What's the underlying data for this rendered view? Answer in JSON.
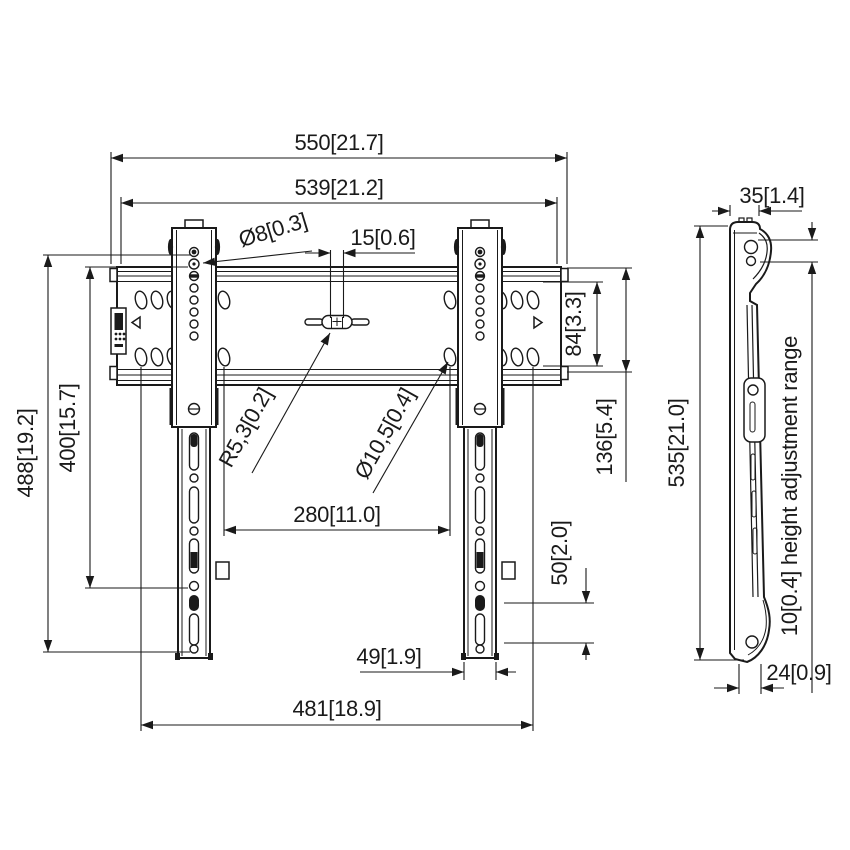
{
  "drawing": {
    "background": "#ffffff",
    "line_color": "#1a1a1a",
    "units_format": "mm[inch]"
  },
  "front_view": {
    "dimensions": {
      "outer_width": "550[21.7]",
      "inner_width": "539[21.2]",
      "screw_hole_diameter": "Ø8[0.3]",
      "center_slot_width": "15[0.6]",
      "slot_row_gap": "84[3.3]",
      "rail_height": "136[5.4]",
      "max_hole_span": "488[19.2]",
      "vesa_span": "400[15.7]",
      "slot_radius": "R5,3[0.2]",
      "wall_slot_diameter": "Ø10,5[0.4]",
      "inner_slot_span": "280[11.0]",
      "lower_hole_gap": "50[2.0]",
      "strap_width": "49[1.9]",
      "outer_slot_span": "481[18.9]"
    }
  },
  "side_view": {
    "dimensions": {
      "top_depth": "35[1.4]",
      "total_height": "535[21.0]",
      "height_adjustment_range": "10[0.4] height adjustment range",
      "bottom_depth": "24[0.9]"
    }
  }
}
